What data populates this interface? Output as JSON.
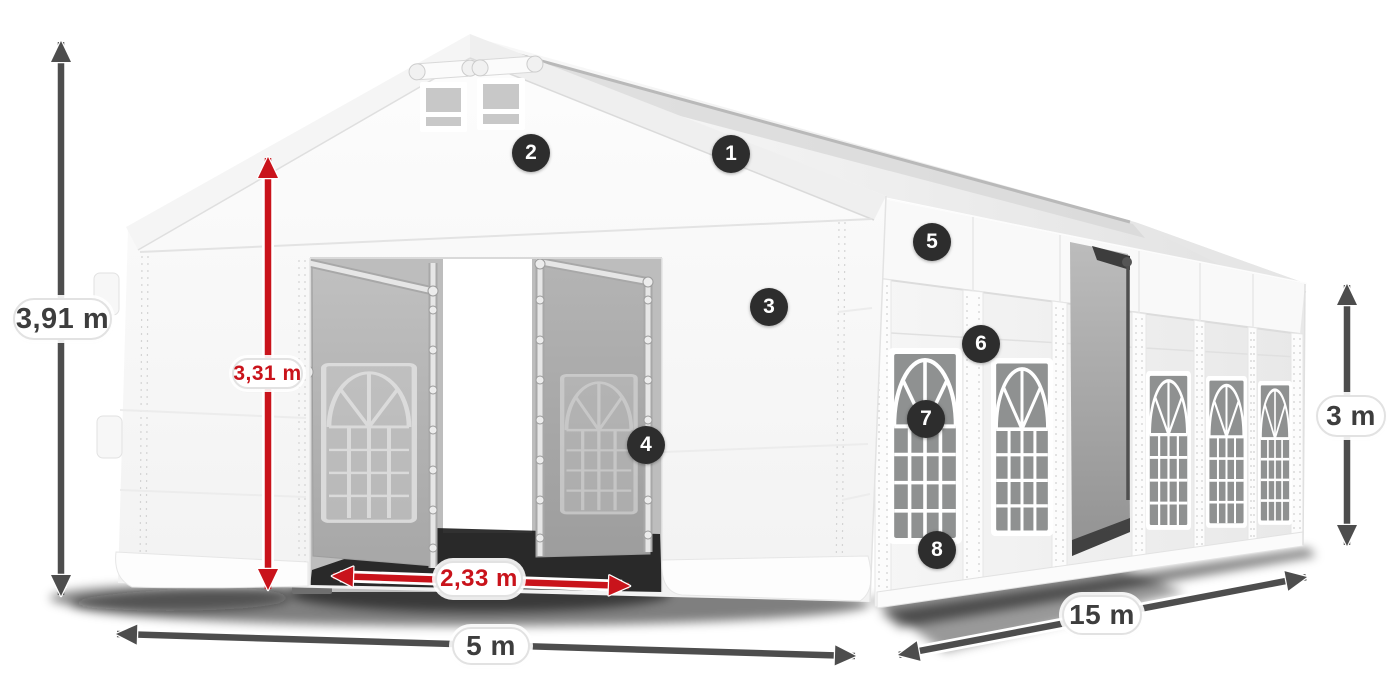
{
  "diagram_labels": {
    "outer_height": "3,91 m",
    "inner_height": "3,31 m",
    "entrance_width": "2,33 m",
    "front_width": "5 m",
    "side_length": "15 m",
    "side_wall_height": "3 m"
  },
  "dimension_labels": [
    {
      "name": "outer-height",
      "text": "3,91 m",
      "color": "dark"
    },
    {
      "name": "inner-height",
      "text": "3,31 m",
      "color": "red"
    },
    {
      "name": "entrance-width",
      "text": "2,33 m",
      "color": "red"
    },
    {
      "name": "front-width",
      "text": "5 m",
      "color": "dark"
    },
    {
      "name": "side-length",
      "text": "15 m",
      "color": "dark"
    },
    {
      "name": "side-wall-height",
      "text": "3 m",
      "color": "dark"
    }
  ],
  "callout_numbers": [
    "1",
    "2",
    "3",
    "4",
    "5",
    "6",
    "7",
    "8"
  ],
  "icons": {
    "dimension_arrow_dark": "double-headed-arrow",
    "dimension_arrow_red": "double-headed-arrow",
    "callout_badge": "numbered-circle"
  },
  "colors": {
    "background": "#ffffff",
    "dimension_red": "#c9131b",
    "dimension_dark": "#4d4d4d",
    "label_text_dark": "#3d3d3d",
    "pill_background": "#ffffff",
    "badge_background": "#2d2d2d",
    "badge_text": "#ffffff",
    "tent_white": "#f7f7f7",
    "tent_interior_gray": "#b5b5b5"
  }
}
